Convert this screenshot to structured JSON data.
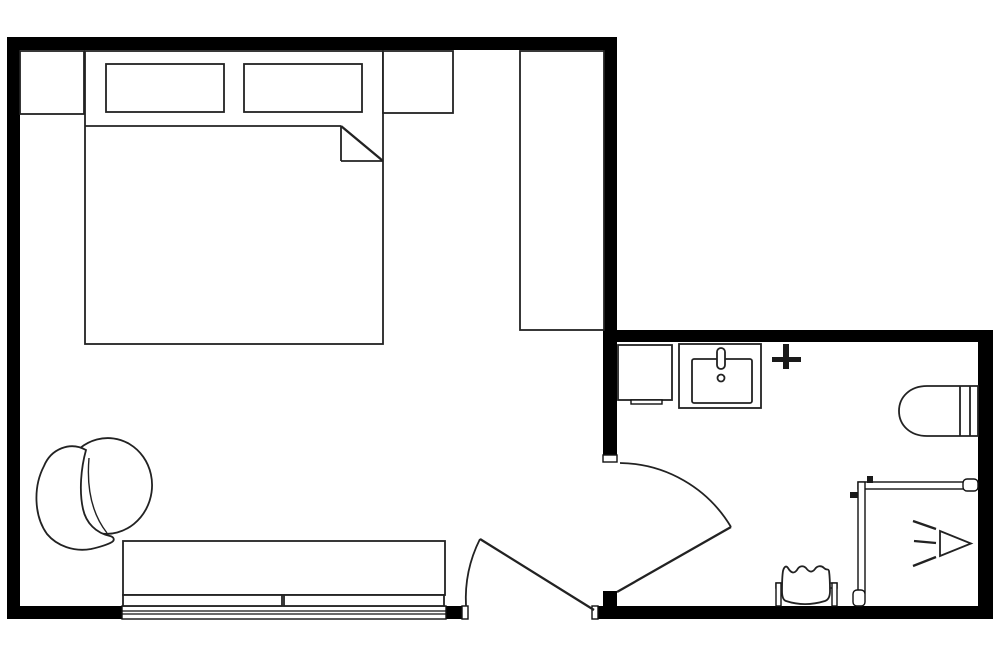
{
  "page": {
    "background": "#ffffff"
  },
  "colors": {
    "wall": "#000000",
    "furniture_stroke": "#222222",
    "fixture_fill": "#ffffff",
    "solid_fixture": "#1a1a1a"
  },
  "canvas": {
    "width": 1000,
    "height": 667
  },
  "floorplan": {
    "rooms": [
      {
        "name": "bedroom"
      },
      {
        "name": "bathroom"
      }
    ],
    "shapes": [
      {
        "name": "top-wall",
        "tag": "rect",
        "interactable": false,
        "attrs": {
          "class": "wall",
          "x": 7,
          "y": 37,
          "width": 610,
          "height": 13
        }
      },
      {
        "name": "left-wall",
        "tag": "rect",
        "interactable": false,
        "attrs": {
          "class": "wall",
          "x": 7,
          "y": 37,
          "width": 13,
          "height": 582
        }
      },
      {
        "name": "bottom-wall-left",
        "tag": "rect",
        "interactable": false,
        "attrs": {
          "class": "wall",
          "x": 7,
          "y": 606,
          "width": 115,
          "height": 13
        }
      },
      {
        "name": "bottom-wall-stub",
        "tag": "rect",
        "interactable": false,
        "attrs": {
          "class": "wall",
          "x": 446,
          "y": 606,
          "width": 16,
          "height": 13
        }
      },
      {
        "name": "bottom-wall-bath",
        "tag": "rect",
        "interactable": false,
        "attrs": {
          "class": "wall",
          "x": 598,
          "y": 606,
          "width": 395,
          "height": 13
        }
      },
      {
        "name": "divider-wall",
        "tag": "rect",
        "interactable": false,
        "attrs": {
          "class": "wall",
          "x": 603,
          "y": 37,
          "width": 14,
          "height": 418
        }
      },
      {
        "name": "divider-hinge-block",
        "tag": "rect",
        "interactable": false,
        "attrs": {
          "class": "wall",
          "x": 603,
          "y": 591,
          "width": 14,
          "height": 16
        }
      },
      {
        "name": "bath-top-wall",
        "tag": "rect",
        "interactable": false,
        "attrs": {
          "class": "wall",
          "x": 617,
          "y": 330,
          "width": 376,
          "height": 12
        }
      },
      {
        "name": "bath-right-wall",
        "tag": "rect",
        "interactable": false,
        "attrs": {
          "class": "wall",
          "x": 978,
          "y": 330,
          "width": 15,
          "height": 289
        }
      },
      {
        "name": "window-frame",
        "tag": "rect",
        "interactable": false,
        "attrs": {
          "class": "thinfx",
          "x": 122,
          "y": 606,
          "width": 324,
          "height": 13
        }
      },
      {
        "name": "window-line-1",
        "tag": "line",
        "interactable": false,
        "attrs": {
          "class": "winln",
          "x1": 122,
          "y1": 611,
          "x2": 446,
          "y2": 611
        }
      },
      {
        "name": "window-line-2",
        "tag": "line",
        "interactable": false,
        "attrs": {
          "class": "winln",
          "x1": 122,
          "y1": 614,
          "x2": 446,
          "y2": 614
        }
      },
      {
        "name": "door-stop-bedroom-left",
        "tag": "rect",
        "interactable": false,
        "attrs": {
          "class": "thinfx",
          "x": 462,
          "y": 606,
          "width": 6,
          "height": 13
        }
      },
      {
        "name": "door-stop-bedroom-right",
        "tag": "rect",
        "interactable": false,
        "attrs": {
          "class": "thinfx",
          "x": 592,
          "y": 606,
          "width": 6,
          "height": 13
        }
      },
      {
        "name": "door-stop-bathroom-top",
        "tag": "rect",
        "interactable": false,
        "attrs": {
          "class": "thinfx",
          "x": 603,
          "y": 455,
          "width": 14,
          "height": 7
        }
      },
      {
        "name": "bedroom-door-leaf",
        "tag": "line",
        "interactable": false,
        "attrs": {
          "class": "heavy",
          "x1": 480,
          "y1": 539,
          "x2": 594,
          "y2": 610
        }
      },
      {
        "name": "bedroom-door-arc",
        "tag": "path",
        "interactable": false,
        "attrs": {
          "class": "arc",
          "d": "M466,606 A133,133 0 0 1 480,539"
        }
      },
      {
        "name": "bathroom-door-leaf",
        "tag": "line",
        "interactable": false,
        "attrs": {
          "class": "heavy",
          "x1": 731,
          "y1": 527,
          "x2": 617,
          "y2": 592
        }
      },
      {
        "name": "bathroom-door-arc",
        "tag": "path",
        "interactable": false,
        "attrs": {
          "class": "arc",
          "d": "M620,463 A131,131 0 0 1 731,527"
        }
      },
      {
        "name": "nightstand-left",
        "tag": "rect",
        "interactable": false,
        "attrs": {
          "class": "furn",
          "x": 20,
          "y": 51,
          "width": 64,
          "height": 63
        }
      },
      {
        "name": "bed",
        "tag": "rect",
        "interactable": false,
        "attrs": {
          "class": "furn",
          "x": 85,
          "y": 51,
          "width": 298,
          "height": 293
        }
      },
      {
        "name": "pillow-left",
        "tag": "rect",
        "interactable": false,
        "attrs": {
          "class": "furn",
          "x": 106,
          "y": 64,
          "width": 118,
          "height": 48
        }
      },
      {
        "name": "pillow-right",
        "tag": "rect",
        "interactable": false,
        "attrs": {
          "class": "furn",
          "x": 244,
          "y": 64,
          "width": 118,
          "height": 48
        }
      },
      {
        "name": "blanket-line",
        "tag": "line",
        "interactable": false,
        "attrs": {
          "class": "line",
          "x1": 85,
          "y1": 126,
          "x2": 341,
          "y2": 126
        }
      },
      {
        "name": "blanket-fold-vertical",
        "tag": "line",
        "interactable": false,
        "attrs": {
          "class": "line",
          "x1": 341,
          "y1": 126,
          "x2": 341,
          "y2": 161
        }
      },
      {
        "name": "blanket-fold-horizontal",
        "tag": "line",
        "interactable": false,
        "attrs": {
          "class": "line",
          "x1": 341,
          "y1": 161,
          "x2": 383,
          "y2": 161
        }
      },
      {
        "name": "blanket-fold-diagonal",
        "tag": "line",
        "interactable": false,
        "attrs": {
          "class": "heavy",
          "x1": 341,
          "y1": 126,
          "x2": 383,
          "y2": 161
        }
      },
      {
        "name": "nightstand-right",
        "tag": "rect",
        "interactable": false,
        "attrs": {
          "class": "furn",
          "x": 383,
          "y": 51,
          "width": 70,
          "height": 62
        }
      },
      {
        "name": "wardrobe",
        "tag": "rect",
        "interactable": false,
        "attrs": {
          "class": "furn",
          "x": 520,
          "y": 51,
          "width": 84,
          "height": 279
        }
      },
      {
        "name": "armchair-seat",
        "tag": "ellipse",
        "interactable": false,
        "attrs": {
          "class": "furn",
          "cx": 107,
          "cy": 486,
          "rx": 45,
          "ry": 48,
          "transform": "rotate(8 107 486)"
        }
      },
      {
        "name": "armchair-back-cushion",
        "tag": "path",
        "interactable": false,
        "attrs": {
          "class": "furn",
          "d": "M86,450 C70,441 51,449 44,466 C33,487 34,516 47,534 C57,546 74,552 91,549 C100,547 107,545 112,542 C115,540 114,537 110,536 C96,533 86,523 83,509 C79,491 81,468 86,450 Z"
        }
      },
      {
        "name": "armchair-seam",
        "tag": "path",
        "interactable": false,
        "attrs": {
          "class": "seam",
          "d": "M89,458 Q85,505 107,533"
        }
      },
      {
        "name": "bench",
        "tag": "rect",
        "interactable": false,
        "attrs": {
          "class": "furn",
          "x": 123,
          "y": 541,
          "width": 322,
          "height": 54
        }
      },
      {
        "name": "bench-rail-left",
        "tag": "rect",
        "interactable": false,
        "attrs": {
          "class": "furn",
          "x": 123,
          "y": 595,
          "width": 159,
          "height": 11
        }
      },
      {
        "name": "bench-rail-right",
        "tag": "rect",
        "interactable": false,
        "attrs": {
          "class": "furn",
          "x": 284,
          "y": 595,
          "width": 160,
          "height": 11
        }
      },
      {
        "name": "bath-cabinet",
        "tag": "rect",
        "interactable": false,
        "attrs": {
          "class": "furn",
          "x": 618,
          "y": 345,
          "width": 54,
          "height": 55
        }
      },
      {
        "name": "bath-cabinet-tab",
        "tag": "rect",
        "interactable": false,
        "attrs": {
          "class": "thinfx",
          "x": 631,
          "y": 400,
          "width": 31,
          "height": 4
        }
      },
      {
        "name": "vanity-counter",
        "tag": "rect",
        "interactable": false,
        "attrs": {
          "class": "furn",
          "x": 679,
          "y": 344,
          "width": 82,
          "height": 64
        }
      },
      {
        "name": "vanity-basin",
        "tag": "rect",
        "interactable": false,
        "attrs": {
          "class": "furn",
          "x": 692,
          "y": 359,
          "width": 60,
          "height": 44,
          "rx": 2
        }
      },
      {
        "name": "vanity-faucet",
        "tag": "rect",
        "interactable": false,
        "attrs": {
          "class": "furn",
          "x": 717,
          "y": 348,
          "width": 8,
          "height": 21,
          "rx": 4
        }
      },
      {
        "name": "vanity-drain",
        "tag": "circle",
        "interactable": false,
        "attrs": {
          "class": "furn",
          "cx": 721,
          "cy": 378,
          "r": 3.5
        }
      },
      {
        "name": "wall-cross-fixture-vertical",
        "tag": "rect",
        "interactable": false,
        "attrs": {
          "class": "solid",
          "x": 783,
          "y": 344,
          "width": 6,
          "height": 25
        }
      },
      {
        "name": "wall-cross-fixture-horizontal",
        "tag": "rect",
        "interactable": false,
        "attrs": {
          "class": "solid",
          "x": 772,
          "y": 357,
          "width": 29,
          "height": 5
        }
      },
      {
        "name": "toilet-body",
        "tag": "path",
        "interactable": false,
        "attrs": {
          "class": "furn",
          "d": "M978,386 L927,386 C910,386 899,397 899,411 C899,425 910,436 927,436 L978,436 Z"
        }
      },
      {
        "name": "toilet-tank-line-1",
        "tag": "line",
        "interactable": false,
        "attrs": {
          "class": "line",
          "x1": 960,
          "y1": 386,
          "x2": 960,
          "y2": 436
        }
      },
      {
        "name": "toilet-tank-line-2",
        "tag": "line",
        "interactable": false,
        "attrs": {
          "class": "line",
          "x1": 970,
          "y1": 386,
          "x2": 970,
          "y2": 436
        }
      },
      {
        "name": "shower-top-panel",
        "tag": "rect",
        "interactable": false,
        "attrs": {
          "class": "thinfx",
          "x": 858,
          "y": 482,
          "width": 120,
          "height": 7
        }
      },
      {
        "name": "shower-side-panel",
        "tag": "rect",
        "interactable": false,
        "attrs": {
          "class": "thinfx",
          "x": 858,
          "y": 482,
          "width": 7,
          "height": 111
        }
      },
      {
        "name": "shower-top-cap",
        "tag": "rect",
        "interactable": false,
        "attrs": {
          "class": "thinfx",
          "x": 963,
          "y": 479,
          "width": 15,
          "height": 12,
          "rx": 4
        }
      },
      {
        "name": "shower-side-cap",
        "tag": "rect",
        "interactable": false,
        "attrs": {
          "class": "thinfx",
          "x": 853,
          "y": 590,
          "width": 12,
          "height": 16,
          "rx": 4
        }
      },
      {
        "name": "shower-hinge-top",
        "tag": "rect",
        "interactable": false,
        "attrs": {
          "class": "solid",
          "x": 867,
          "y": 476,
          "width": 6,
          "height": 7
        }
      },
      {
        "name": "shower-hinge-left",
        "tag": "rect",
        "interactable": false,
        "attrs": {
          "class": "solid",
          "x": 850,
          "y": 492,
          "width": 8,
          "height": 6
        }
      },
      {
        "name": "shower-head",
        "tag": "polygon",
        "interactable": false,
        "attrs": {
          "class": "furn",
          "points": "940,531 940,556 971,543.5"
        }
      },
      {
        "name": "shower-spray-line-1",
        "tag": "line",
        "interactable": false,
        "attrs": {
          "class": "heavy",
          "x1": 913,
          "y1": 521,
          "x2": 936,
          "y2": 529
        }
      },
      {
        "name": "shower-spray-line-2",
        "tag": "line",
        "interactable": false,
        "attrs": {
          "class": "heavy",
          "x1": 914,
          "y1": 541,
          "x2": 936,
          "y2": 543
        }
      },
      {
        "name": "shower-spray-line-3",
        "tag": "line",
        "interactable": false,
        "attrs": {
          "class": "heavy",
          "x1": 913,
          "y1": 566,
          "x2": 936,
          "y2": 557
        }
      },
      {
        "name": "towel-rail-bar",
        "tag": "rect",
        "interactable": false,
        "attrs": {
          "class": "thinfx",
          "x": 776,
          "y": 583,
          "width": 61,
          "height": 5
        }
      },
      {
        "name": "towel-post-left",
        "tag": "rect",
        "interactable": false,
        "attrs": {
          "class": "thinfx",
          "x": 776,
          "y": 583,
          "width": 5,
          "height": 23
        }
      },
      {
        "name": "towel-post-right",
        "tag": "rect",
        "interactable": false,
        "attrs": {
          "class": "thinfx",
          "x": 832,
          "y": 583,
          "width": 5,
          "height": 23
        }
      },
      {
        "name": "towel",
        "tag": "path",
        "interactable": false,
        "attrs": {
          "class": "furn",
          "d": "M786,601 C783,600 782,596 782,591 C782,584 782,577 783,571 C784,567 786,565 788,568 C791,573 794,574 797,570 C799,566 803,565 806,568 C809,572 812,573 815,569 C817,566 821,565 824,568 C827,571 828,568 829,571 C830,578 830,586 830,591 C830,597 828,600 825,601 C812,605 798,605 786,601 Z"
        }
      }
    ]
  }
}
